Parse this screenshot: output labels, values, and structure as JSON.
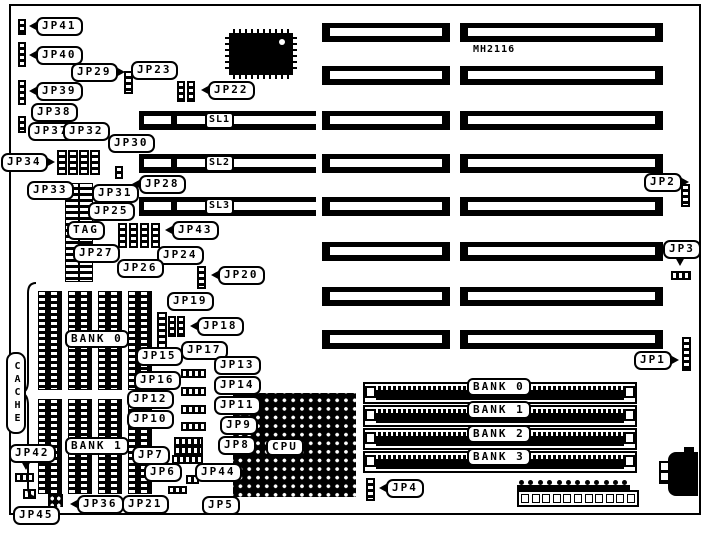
{
  "colors": {
    "ink": "#000000",
    "paper": "#ffffff"
  },
  "chipset_label": "MH2116",
  "cpu": {
    "label": "CPU",
    "socket": {
      "x": 233,
      "y": 393,
      "w": 123,
      "h": 104
    },
    "center": {
      "x": 258,
      "y": 414,
      "w": 60,
      "h": 62
    },
    "dot": {
      "x": 303,
      "y": 464
    }
  },
  "cache": {
    "label": "CACHE",
    "label_box": {
      "x": 6,
      "y": 352,
      "w": 18,
      "h": 80
    },
    "brace": {
      "x": 20,
      "y": 281,
      "w": 18,
      "h": 218
    }
  },
  "callouts": [
    {
      "text": "JP41",
      "x": 36,
      "y": 17,
      "tail": "left"
    },
    {
      "text": "JP40",
      "x": 36,
      "y": 46,
      "tail": "left"
    },
    {
      "text": "JP29",
      "x": 71,
      "y": 63,
      "tail": "right"
    },
    {
      "text": "JP23",
      "x": 131,
      "y": 61,
      "tail": "none"
    },
    {
      "text": "JP22",
      "x": 208,
      "y": 81,
      "tail": "left"
    },
    {
      "text": "JP39",
      "x": 36,
      "y": 82,
      "tail": "left"
    },
    {
      "text": "JP38",
      "x": 31,
      "y": 103,
      "tail": "none"
    },
    {
      "text": "JP37",
      "x": 28,
      "y": 122,
      "tail": "none"
    },
    {
      "text": "JP32",
      "x": 63,
      "y": 122,
      "tail": "none"
    },
    {
      "text": "JP30",
      "x": 108,
      "y": 134,
      "tail": "none"
    },
    {
      "text": "JP34",
      "x": 1,
      "y": 153,
      "tail": "right"
    },
    {
      "text": "JP33",
      "x": 27,
      "y": 181,
      "tail": "none"
    },
    {
      "text": "JP31",
      "x": 92,
      "y": 184,
      "tail": "none"
    },
    {
      "text": "JP28",
      "x": 139,
      "y": 175,
      "tail": "left"
    },
    {
      "text": "JP25",
      "x": 88,
      "y": 202,
      "tail": "none"
    },
    {
      "text": "TAG",
      "x": 67,
      "y": 221,
      "tail": "none"
    },
    {
      "text": "JP43",
      "x": 172,
      "y": 221,
      "tail": "left"
    },
    {
      "text": "JP27",
      "x": 73,
      "y": 244,
      "tail": "none"
    },
    {
      "text": "JP24",
      "x": 157,
      "y": 246,
      "tail": "none"
    },
    {
      "text": "JP26",
      "x": 117,
      "y": 259,
      "tail": "none"
    },
    {
      "text": "JP20",
      "x": 218,
      "y": 266,
      "tail": "left"
    },
    {
      "text": "JP19",
      "x": 167,
      "y": 292,
      "tail": "none"
    },
    {
      "text": "JP18",
      "x": 197,
      "y": 317,
      "tail": "left"
    },
    {
      "text": "JP17",
      "x": 181,
      "y": 341,
      "tail": "none"
    },
    {
      "text": "JP15",
      "x": 136,
      "y": 347,
      "tail": "none"
    },
    {
      "text": "JP13",
      "x": 214,
      "y": 356,
      "tail": "none"
    },
    {
      "text": "JP16",
      "x": 134,
      "y": 371,
      "tail": "none"
    },
    {
      "text": "JP14",
      "x": 214,
      "y": 376,
      "tail": "none"
    },
    {
      "text": "JP12",
      "x": 127,
      "y": 390,
      "tail": "none"
    },
    {
      "text": "JP11",
      "x": 214,
      "y": 396,
      "tail": "none"
    },
    {
      "text": "JP10",
      "x": 127,
      "y": 410,
      "tail": "none"
    },
    {
      "text": "JP9",
      "x": 220,
      "y": 416,
      "tail": "none"
    },
    {
      "text": "JP8",
      "x": 218,
      "y": 436,
      "tail": "none"
    },
    {
      "text": "JP7",
      "x": 132,
      "y": 446,
      "tail": "none"
    },
    {
      "text": "JP6",
      "x": 144,
      "y": 463,
      "tail": "none"
    },
    {
      "text": "JP44",
      "x": 195,
      "y": 463,
      "tail": "none"
    },
    {
      "text": "JP42",
      "x": 9,
      "y": 444,
      "tail": "down"
    },
    {
      "text": "JP36",
      "x": 77,
      "y": 495,
      "tail": "left"
    },
    {
      "text": "JP21",
      "x": 122,
      "y": 495,
      "tail": "none"
    },
    {
      "text": "JP5",
      "x": 202,
      "y": 496,
      "tail": "none"
    },
    {
      "text": "JP45",
      "x": 13,
      "y": 506,
      "tail": "none"
    },
    {
      "text": "JP2",
      "x": 644,
      "y": 173,
      "tail": "right"
    },
    {
      "text": "JP3",
      "x": 663,
      "y": 240,
      "tail": "down"
    },
    {
      "text": "JP1",
      "x": 634,
      "y": 351,
      "tail": "right"
    },
    {
      "text": "JP4",
      "x": 386,
      "y": 479,
      "tail": "left"
    }
  ],
  "box_labels": [
    {
      "text": "SL1",
      "x": 205,
      "y": 112,
      "cls": "sl"
    },
    {
      "text": "SL2",
      "x": 205,
      "y": 155,
      "cls": "sl"
    },
    {
      "text": "SL3",
      "x": 205,
      "y": 198,
      "cls": "sl"
    },
    {
      "text": "BANK 0",
      "x": 65,
      "y": 330,
      "cls": ""
    },
    {
      "text": "BANK 1",
      "x": 65,
      "y": 437,
      "cls": ""
    },
    {
      "text": "BANK 0",
      "x": 467,
      "y": 378,
      "cls": ""
    },
    {
      "text": "BANK 1",
      "x": 467,
      "y": 401,
      "cls": ""
    },
    {
      "text": "BANK 2",
      "x": 467,
      "y": 425,
      "cls": ""
    },
    {
      "text": "BANK 3",
      "x": 467,
      "y": 448,
      "cls": ""
    },
    {
      "text": "CPU",
      "x": 266,
      "y": 438,
      "cls": ""
    }
  ],
  "slots": {
    "row_h": 19,
    "mid": {
      "x": 322,
      "w": 128,
      "ys": [
        23,
        66,
        111,
        154,
        197,
        242,
        287,
        330
      ]
    },
    "right": {
      "x": 460,
      "w": 203,
      "ys": [
        23,
        66,
        111,
        154,
        197,
        242,
        287,
        330
      ]
    },
    "vlb": {
      "x": 139,
      "w": 177,
      "ys": [
        111,
        154,
        197
      ]
    }
  },
  "simm": {
    "x": 363,
    "w": 270,
    "h": 18,
    "ys": [
      382,
      405,
      428,
      451
    ]
  },
  "cache_chips": {
    "xs": [
      38,
      68,
      98,
      128
    ],
    "w": 22,
    "banks": [
      {
        "y": 291,
        "h": 97
      },
      {
        "y": 399,
        "h": 93
      }
    ]
  },
  "tag_chips": [
    {
      "x": 65,
      "y": 183,
      "w": 12,
      "h": 97
    },
    {
      "x": 79,
      "y": 183,
      "w": 12,
      "h": 97
    }
  ],
  "jumpers": [
    {
      "x": 18,
      "y": 19,
      "w": 8,
      "h": 16,
      "o": "v"
    },
    {
      "x": 18,
      "y": 42,
      "w": 8,
      "h": 25,
      "o": "v"
    },
    {
      "x": 18,
      "y": 80,
      "w": 8,
      "h": 25,
      "o": "v"
    },
    {
      "x": 18,
      "y": 116,
      "w": 8,
      "h": 17,
      "o": "v"
    },
    {
      "x": 124,
      "y": 71,
      "w": 9,
      "h": 23,
      "o": "v"
    },
    {
      "x": 177,
      "y": 81,
      "w": 8,
      "h": 21,
      "o": "v"
    },
    {
      "x": 187,
      "y": 81,
      "w": 8,
      "h": 21,
      "o": "v"
    },
    {
      "x": 57,
      "y": 150,
      "w": 10,
      "h": 25,
      "o": "v"
    },
    {
      "x": 68,
      "y": 150,
      "w": 10,
      "h": 25,
      "o": "v"
    },
    {
      "x": 79,
      "y": 150,
      "w": 10,
      "h": 25,
      "o": "v"
    },
    {
      "x": 90,
      "y": 150,
      "w": 10,
      "h": 25,
      "o": "v"
    },
    {
      "x": 115,
      "y": 166,
      "w": 8,
      "h": 13,
      "o": "v"
    },
    {
      "x": 118,
      "y": 223,
      "w": 9,
      "h": 25,
      "o": "v"
    },
    {
      "x": 129,
      "y": 223,
      "w": 9,
      "h": 25,
      "o": "v"
    },
    {
      "x": 140,
      "y": 223,
      "w": 9,
      "h": 25,
      "o": "v"
    },
    {
      "x": 151,
      "y": 223,
      "w": 9,
      "h": 25,
      "o": "v"
    },
    {
      "x": 197,
      "y": 266,
      "w": 9,
      "h": 23,
      "o": "v"
    },
    {
      "x": 157,
      "y": 312,
      "w": 10,
      "h": 38,
      "o": "v"
    },
    {
      "x": 168,
      "y": 316,
      "w": 8,
      "h": 21,
      "o": "v"
    },
    {
      "x": 177,
      "y": 316,
      "w": 8,
      "h": 21,
      "o": "v"
    },
    {
      "x": 181,
      "y": 369,
      "w": 25,
      "h": 9,
      "o": "h"
    },
    {
      "x": 181,
      "y": 387,
      "w": 25,
      "h": 9,
      "o": "h"
    },
    {
      "x": 181,
      "y": 405,
      "w": 25,
      "h": 9,
      "o": "h"
    },
    {
      "x": 181,
      "y": 422,
      "w": 25,
      "h": 9,
      "o": "h"
    },
    {
      "x": 174,
      "y": 437,
      "w": 29,
      "h": 9,
      "o": "h"
    },
    {
      "x": 174,
      "y": 446,
      "w": 29,
      "h": 9,
      "o": "h"
    },
    {
      "x": 172,
      "y": 455,
      "w": 31,
      "h": 9,
      "o": "h"
    },
    {
      "x": 168,
      "y": 486,
      "w": 19,
      "h": 8,
      "o": "h"
    },
    {
      "x": 186,
      "y": 475,
      "w": 13,
      "h": 9,
      "o": "h"
    },
    {
      "x": 15,
      "y": 473,
      "w": 19,
      "h": 9,
      "o": "h"
    },
    {
      "x": 23,
      "y": 489,
      "w": 13,
      "h": 10,
      "o": "h"
    },
    {
      "x": 48,
      "y": 494,
      "w": 19,
      "h": 17,
      "o": "g"
    },
    {
      "x": 366,
      "y": 478,
      "w": 9,
      "h": 23,
      "o": "v"
    },
    {
      "x": 681,
      "y": 184,
      "w": 9,
      "h": 23,
      "o": "v"
    },
    {
      "x": 671,
      "y": 271,
      "w": 20,
      "h": 9,
      "o": "h"
    },
    {
      "x": 682,
      "y": 337,
      "w": 9,
      "h": 34,
      "o": "v"
    }
  ],
  "qfp": {
    "x": 229,
    "y": 33,
    "w": 64,
    "h": 42
  },
  "power": {
    "x": 517,
    "y": 480,
    "dots": 12,
    "squares": 11
  },
  "board": {
    "x": 9,
    "y": 4,
    "w": 688,
    "h": 507
  }
}
